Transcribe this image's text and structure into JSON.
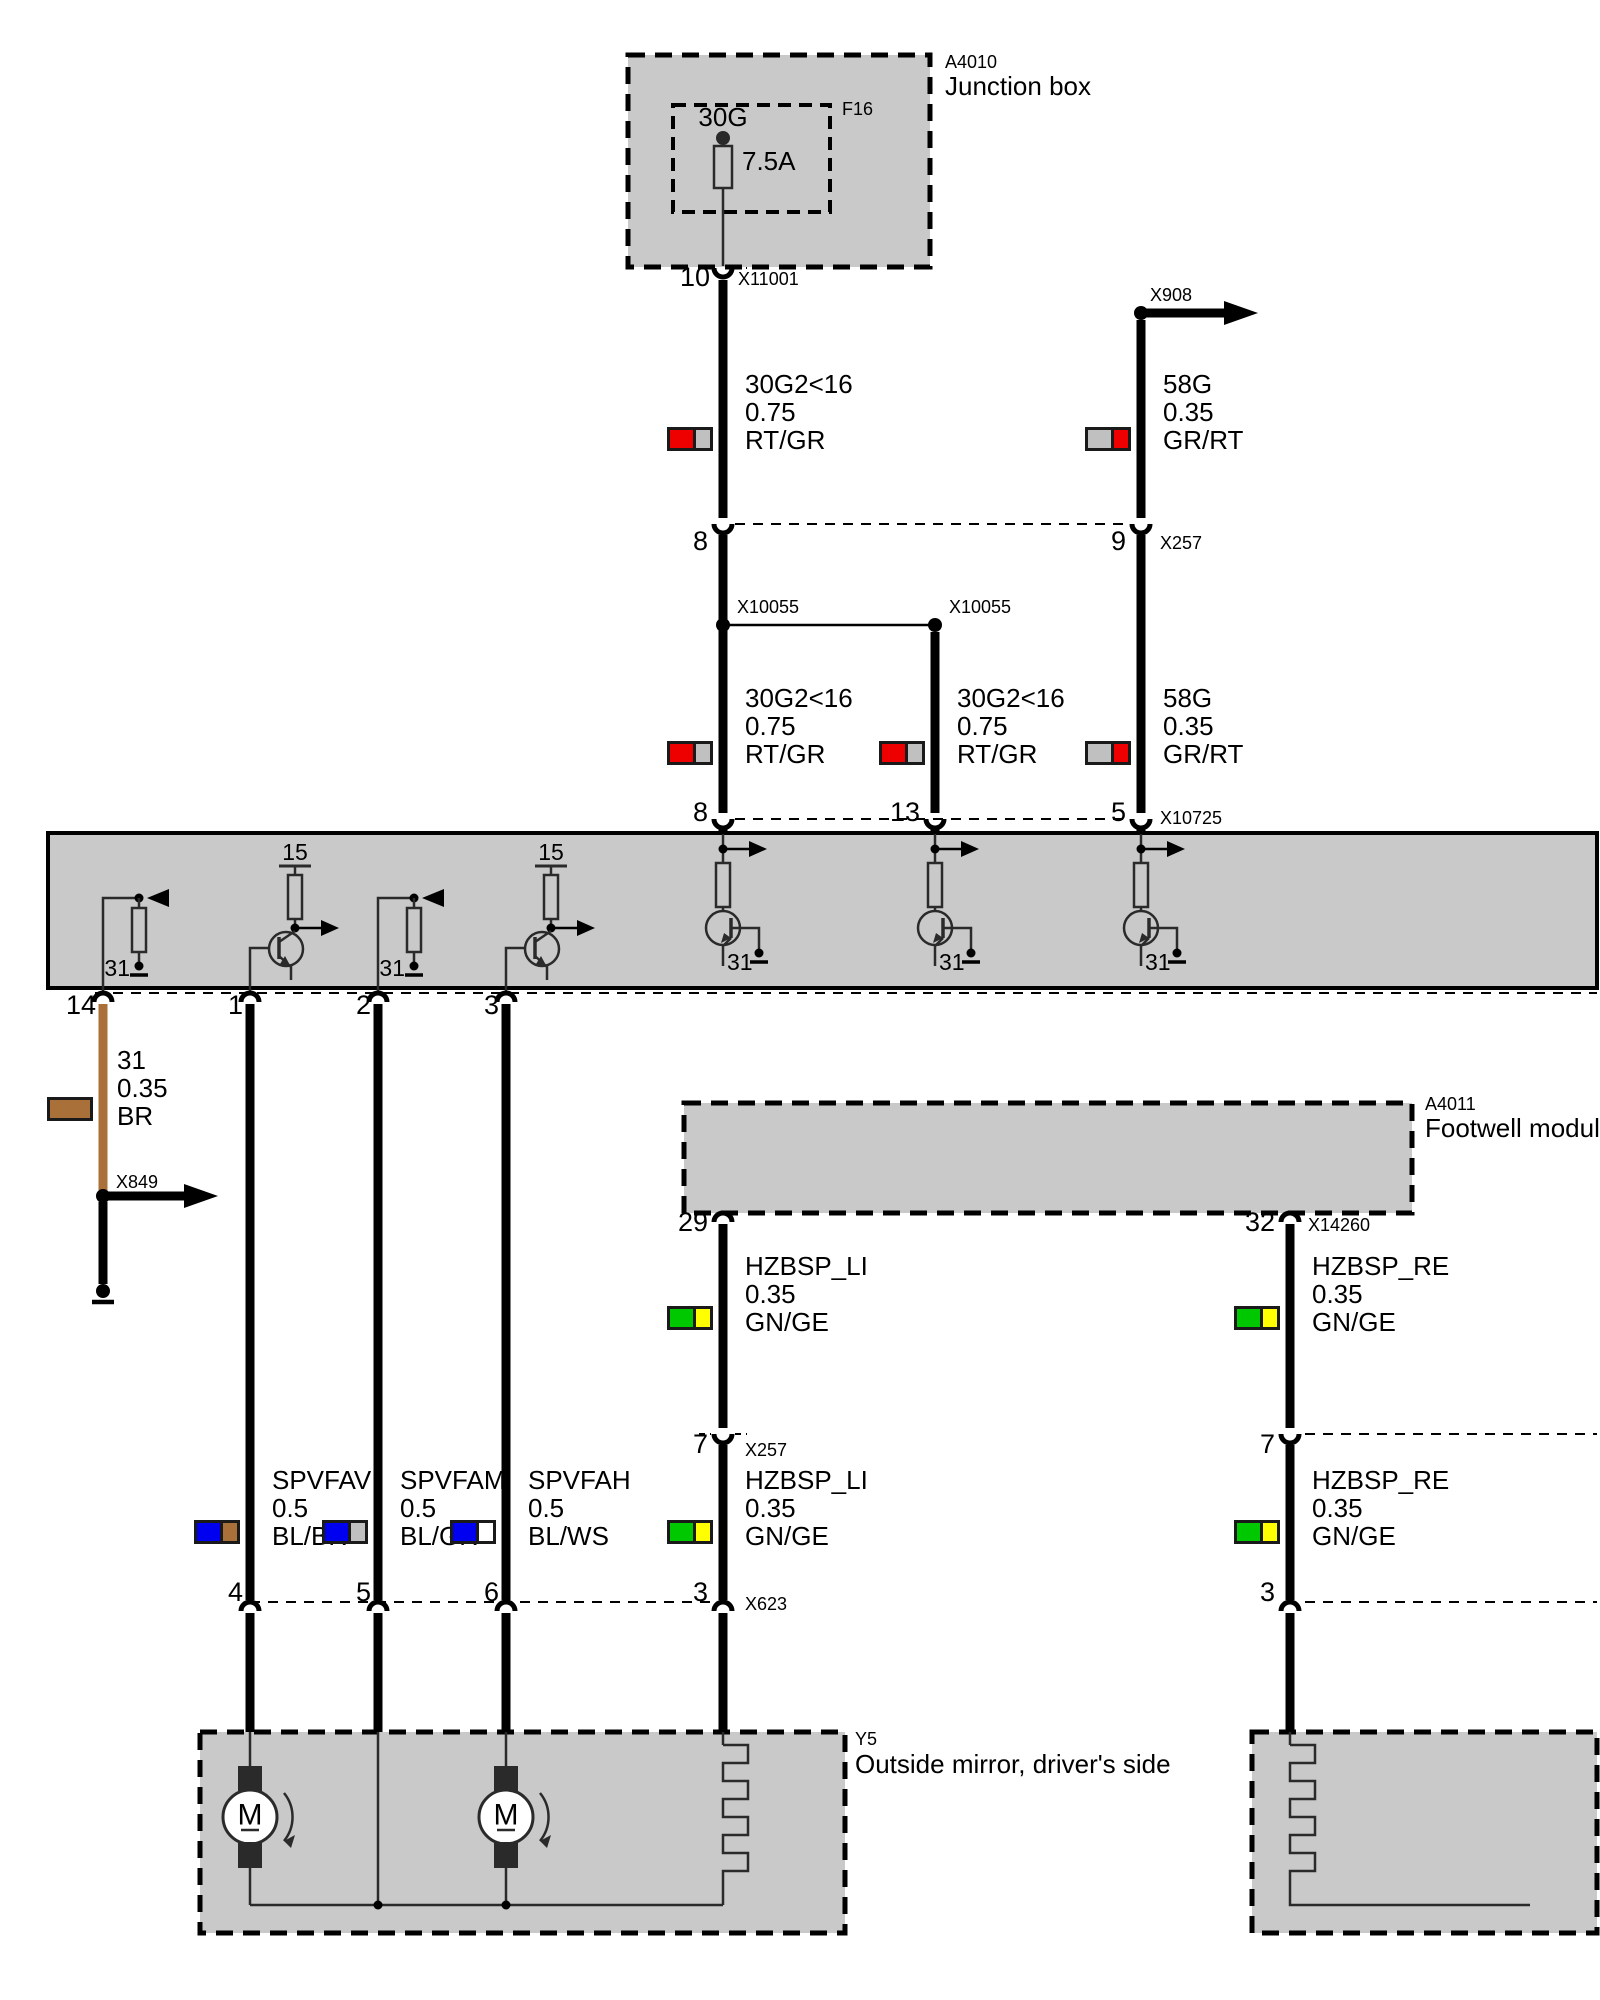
{
  "junction_box": {
    "code": "A4010",
    "name": "Junction box",
    "fuse_id": "F16",
    "fuse_terminal": "30G",
    "fuse_rating": "7.5A",
    "pin": "10",
    "connector": "X11001"
  },
  "arrow_x908": {
    "label": "X908"
  },
  "arrow_x849": {
    "label": "X849"
  },
  "splice_left": {
    "label": "X10055"
  },
  "splice_right": {
    "label": "X10055"
  },
  "row_x257_top": {
    "pin_left": "8",
    "pin_right": "9",
    "label": "X257"
  },
  "row_x10725": {
    "pin_1": "8",
    "pin_2": "13",
    "pin_3": "5",
    "label": "X10725"
  },
  "band": {
    "t15_a": "15",
    "t15_b": "15",
    "t31_a": "31",
    "t31_b": "31",
    "t31_c": "31",
    "t31_d": "31",
    "t31_e": "31",
    "pin_14": "14",
    "pin_1": "1",
    "pin_2": "2",
    "pin_3": "3"
  },
  "footwell": {
    "code": "A4011",
    "name": "Footwell module",
    "pin_left": "29",
    "pin_right": "32",
    "connector": "X14260"
  },
  "row_x257_mid": {
    "pin_left": "7",
    "pin_right": "7",
    "label": "X257"
  },
  "row_x623": {
    "pin_1": "4",
    "pin_2": "5",
    "pin_3": "6",
    "pin_4": "3",
    "pin_right": "3",
    "label": "X623"
  },
  "mirror_driver": {
    "code": "Y5",
    "name": "Outside mirror, driver's side",
    "motor_letter": "M"
  },
  "colors": {
    "red": "#ee0000",
    "gray": "#c0c0c0",
    "green": "#00c800",
    "yellow": "#ffff00",
    "blue": "#0000f0",
    "brown": "#a9703a",
    "white": "#ffffff",
    "box_fill": "#c9c9c9"
  },
  "wire_labels": [
    {
      "name": "30G2<16",
      "size": "0.75",
      "color": "RT/GR",
      "c1": "#ee0000",
      "c2": "#c0c0c0"
    },
    {
      "name": "58G",
      "size": "0.35",
      "color": "GR/RT",
      "c1": "#c0c0c0",
      "c2": "#ee0000"
    },
    {
      "name": "30G2<16",
      "size": "0.75",
      "color": "RT/GR",
      "c1": "#ee0000",
      "c2": "#c0c0c0"
    },
    {
      "name": "30G2<16",
      "size": "0.75",
      "color": "RT/GR",
      "c1": "#ee0000",
      "c2": "#c0c0c0"
    },
    {
      "name": "58G",
      "size": "0.35",
      "color": "GR/RT",
      "c1": "#c0c0c0",
      "c2": "#ee0000"
    },
    {
      "name": "31",
      "size": "0.35",
      "color": "BR",
      "c1": "#a9703a",
      "c2": "#a9703a"
    },
    {
      "name": "HZBSP_LI",
      "size": "0.35",
      "color": "GN/GE",
      "c1": "#00c800",
      "c2": "#ffff00"
    },
    {
      "name": "HZBSP_RE",
      "size": "0.35",
      "color": "GN/GE",
      "c1": "#00c800",
      "c2": "#ffff00"
    },
    {
      "name": "SPVFAV",
      "size": "0.5",
      "color": "BL/BR",
      "c1": "#0000f0",
      "c2": "#a9703a"
    },
    {
      "name": "SPVFAM",
      "size": "0.5",
      "color": "BL/GR",
      "c1": "#0000f0",
      "c2": "#c0c0c0"
    },
    {
      "name": "SPVFAH",
      "size": "0.5",
      "color": "BL/WS",
      "c1": "#0000f0",
      "c2": "#ffffff"
    },
    {
      "name": "HZBSP_LI",
      "size": "0.35",
      "color": "GN/GE",
      "c1": "#00c800",
      "c2": "#ffff00"
    },
    {
      "name": "HZBSP_RE",
      "size": "0.35",
      "color": "GN/GE",
      "c1": "#00c800",
      "c2": "#ffff00"
    }
  ]
}
